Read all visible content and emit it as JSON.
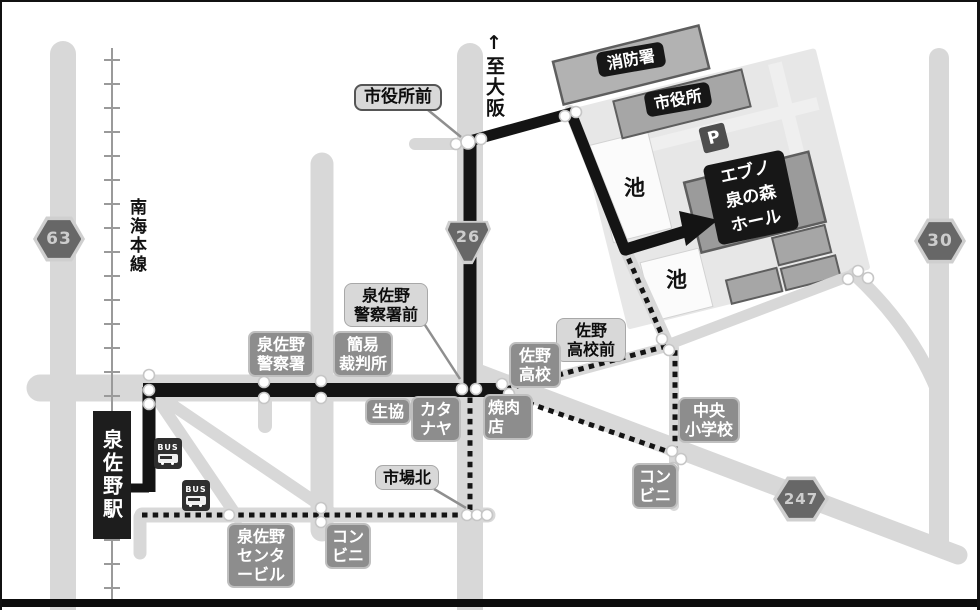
{
  "colors": {
    "road": "#d8d8d8",
    "route_black": "#141414",
    "campus_bg": "#e7e7e7",
    "building": "#a6a6a6",
    "badge": "#676767",
    "label_gray_bg": "#8d8d8d",
    "label_light_bg": "#d8d8d8",
    "label_black_bg": "#171717"
  },
  "destination": {
    "hall": [
      "エブノ",
      "泉の森",
      "ホール"
    ]
  },
  "rail": {
    "station": "泉佐野駅",
    "line_name": "南海本線"
  },
  "direction": {
    "arrow": "↑",
    "to_osaka": "至大阪"
  },
  "route_badges": {
    "r63": "63",
    "r26": "26",
    "r30": "30",
    "r247": "247"
  },
  "facilities": {
    "fire_station": "消防署",
    "city_hall": "市役所",
    "parking": "P",
    "pond1": "池",
    "pond2": "池",
    "police": [
      "泉佐野",
      "警察署"
    ],
    "court": [
      "簡易",
      "裁判所"
    ],
    "coop": "生協",
    "katanaya": [
      "カタ",
      "ナヤ"
    ],
    "yakiniku": [
      "焼肉",
      "店"
    ],
    "sano_hs": [
      "佐野",
      "高校"
    ],
    "chuo_es": [
      "中央",
      "小学校"
    ],
    "conv_east": [
      "コン",
      "ビニ"
    ],
    "conv_west": [
      "コン",
      "ビニ"
    ],
    "center_bldg": [
      "泉佐野",
      "センタ",
      "ービル"
    ],
    "bus1": "BUS",
    "bus2": "BUS"
  },
  "intersections": {
    "city_hall_front": "市役所前",
    "police_front": [
      "泉佐野",
      "警察署前"
    ],
    "sano_hs_front": [
      "佐野",
      "高校前"
    ],
    "ichiba_kita": "市場北"
  }
}
